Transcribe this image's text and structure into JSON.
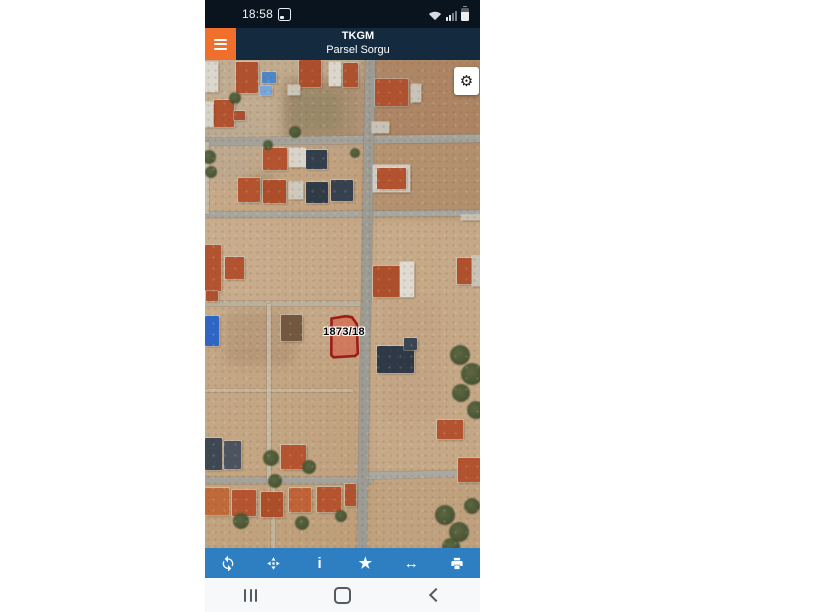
{
  "statusbar": {
    "time": "18:58",
    "bg": "#0a141f",
    "icons": [
      "screenshot-icon",
      "wifi-icon",
      "signal-icon",
      "battery-icon"
    ]
  },
  "header": {
    "title": "TKGM",
    "subtitle": "Parsel Sorgu",
    "bg": "#142a3f",
    "menu_color": "#f16f2c"
  },
  "map": {
    "parcel_label": "1873/18",
    "parcel_fill": "rgba(219,85,64,0.55)",
    "parcel_stroke": "#9d1c17",
    "gear_glyph": "⚙",
    "patches": [
      {
        "x": -10,
        "y": -10,
        "w": 180,
        "h": 100,
        "color": "rgba(190,174,152,0.55)"
      },
      {
        "x": 78,
        "y": 18,
        "w": 80,
        "h": 65,
        "color": "rgba(152,118,85,0.5)"
      },
      {
        "x": 160,
        "y": -10,
        "w": 130,
        "h": 95,
        "color": "rgba(164,122,90,0.65)"
      },
      {
        "x": 162,
        "y": 88,
        "w": 120,
        "h": 68,
        "color": "rgba(170,133,100,0.5)"
      },
      {
        "x": -10,
        "y": 158,
        "w": 175,
        "h": 130,
        "color": "rgba(203,177,147,0.5)"
      },
      {
        "x": -10,
        "y": 255,
        "w": 175,
        "h": 175,
        "color": "rgba(196,168,133,0.5)"
      },
      {
        "x": 165,
        "y": 158,
        "w": 120,
        "h": 260,
        "color": "rgba(206,182,152,0.55)"
      },
      {
        "x": 165,
        "y": 412,
        "w": 120,
        "h": 86,
        "color": "rgba(198,171,139,0.5)"
      },
      {
        "x": -10,
        "y": 420,
        "w": 185,
        "h": 80,
        "color": "rgba(192,161,124,0.5)"
      },
      {
        "x": 82,
        "y": 30,
        "w": 55,
        "h": 42,
        "color": "rgba(122,126,92,0.35)"
      },
      {
        "x": 38,
        "y": 116,
        "w": 34,
        "h": 20,
        "color": "rgba(112,120,88,0.4)"
      },
      {
        "x": 20,
        "y": 250,
        "w": 70,
        "h": 55,
        "color": "rgba(152,122,92,0.3)"
      },
      {
        "x": 175,
        "y": 240,
        "w": 60,
        "h": 120,
        "color": "rgba(188,158,128,0.35)"
      },
      {
        "x": -10,
        "y": 60,
        "w": 60,
        "h": 60,
        "color": "rgba(180,168,150,0.4)"
      }
    ],
    "roads": [
      {
        "x": -5,
        "y": 76,
        "w": 290,
        "h": 8,
        "color": "#a3a29b",
        "rot": -0.7
      },
      {
        "x": -5,
        "y": 151,
        "w": 290,
        "h": 6,
        "color": "#a6a59e",
        "rot": -0.4
      },
      {
        "x": 0,
        "y": 241,
        "w": 163,
        "h": 5,
        "color": "rgba(184,176,158,0.95)"
      },
      {
        "x": 0,
        "y": 329,
        "w": 148,
        "h": 3,
        "color": "rgba(200,190,168,0.6)"
      },
      {
        "x": 0,
        "y": 417,
        "w": 168,
        "h": 7,
        "color": "#a3a29b"
      },
      {
        "x": 162,
        "y": 411,
        "w": 113,
        "h": 7,
        "color": "#a9a8a1",
        "rot": -1.2
      },
      {
        "x": 156,
        "y": -6,
        "w": 10,
        "h": 505,
        "color": "#9c9b94",
        "rot": 1.0
      },
      {
        "x": 62,
        "y": 244,
        "w": 4,
        "h": 178,
        "color": "rgba(197,188,168,0.85)"
      },
      {
        "x": 66,
        "y": 424,
        "w": 4,
        "h": 64,
        "color": "rgba(197,188,168,0.7)"
      },
      {
        "x": 0,
        "y": 82,
        "w": 4,
        "h": 72,
        "color": "rgba(200,195,180,0.7)"
      }
    ],
    "houses": [
      {
        "x": 0,
        "y": 2,
        "w": 13,
        "h": 30,
        "color": "#dcd7cd"
      },
      {
        "x": 31,
        "y": 2,
        "w": 22,
        "h": 31,
        "color": "#b1512e"
      },
      {
        "x": 57,
        "y": 12,
        "w": 14,
        "h": 11,
        "color": "#4e85c8"
      },
      {
        "x": 55,
        "y": 26,
        "w": 12,
        "h": 9,
        "color": "#79a6da"
      },
      {
        "x": 94,
        "y": 0,
        "w": 22,
        "h": 27,
        "color": "#ac4d2b"
      },
      {
        "x": 124,
        "y": 2,
        "w": 12,
        "h": 24,
        "color": "#dcd7cd"
      },
      {
        "x": 138,
        "y": 3,
        "w": 15,
        "h": 24,
        "color": "#ae512e"
      },
      {
        "x": 9,
        "y": 40,
        "w": 20,
        "h": 27,
        "color": "#b2522e"
      },
      {
        "x": 0,
        "y": 42,
        "w": 8,
        "h": 25,
        "color": "#d8d3c8"
      },
      {
        "x": 29,
        "y": 51,
        "w": 11,
        "h": 9,
        "color": "#a85030"
      },
      {
        "x": 170,
        "y": 19,
        "w": 33,
        "h": 27,
        "color": "#b0522f"
      },
      {
        "x": 206,
        "y": 24,
        "w": 10,
        "h": 18,
        "color": "#c9c4b8"
      },
      {
        "x": 167,
        "y": 62,
        "w": 17,
        "h": 11,
        "color": "#c6c2b6"
      },
      {
        "x": 83,
        "y": 25,
        "w": 12,
        "h": 10,
        "color": "#cac5b9"
      },
      {
        "x": 58,
        "y": 88,
        "w": 24,
        "h": 22,
        "color": "#b4532e"
      },
      {
        "x": 84,
        "y": 88,
        "w": 17,
        "h": 19,
        "color": "#d9d4c9"
      },
      {
        "x": 101,
        "y": 90,
        "w": 21,
        "h": 19,
        "color": "#333e4c"
      },
      {
        "x": 33,
        "y": 118,
        "w": 22,
        "h": 24,
        "color": "#b4532e"
      },
      {
        "x": 58,
        "y": 120,
        "w": 23,
        "h": 23,
        "color": "#ad4d2a"
      },
      {
        "x": 84,
        "y": 122,
        "w": 14,
        "h": 17,
        "color": "#cfc9bd"
      },
      {
        "x": 101,
        "y": 122,
        "w": 22,
        "h": 21,
        "color": "#2f3a47"
      },
      {
        "x": 126,
        "y": 120,
        "w": 22,
        "h": 21,
        "color": "#36414f"
      },
      {
        "x": 168,
        "y": 105,
        "w": 37,
        "h": 27,
        "color": "#d2cdc1"
      },
      {
        "x": 172,
        "y": 108,
        "w": 29,
        "h": 21,
        "color": "#b2522f"
      },
      {
        "x": 0,
        "y": 185,
        "w": 16,
        "h": 46,
        "color": "#b4532f"
      },
      {
        "x": 20,
        "y": 197,
        "w": 19,
        "h": 22,
        "color": "#b4532f"
      },
      {
        "x": 1,
        "y": 231,
        "w": 12,
        "h": 10,
        "color": "#ad512f"
      },
      {
        "x": 0,
        "y": 256,
        "w": 14,
        "h": 30,
        "color": "#2e66c8"
      },
      {
        "x": 76,
        "y": 255,
        "w": 21,
        "h": 26,
        "color": "#73573f"
      },
      {
        "x": 168,
        "y": 206,
        "w": 27,
        "h": 31,
        "color": "#ae4f2b"
      },
      {
        "x": 195,
        "y": 202,
        "w": 14,
        "h": 35,
        "color": "#e0dbd1"
      },
      {
        "x": 172,
        "y": 286,
        "w": 37,
        "h": 27,
        "color": "#2e3947"
      },
      {
        "x": 199,
        "y": 278,
        "w": 13,
        "h": 12,
        "color": "#3a4553"
      },
      {
        "x": 252,
        "y": 198,
        "w": 16,
        "h": 26,
        "color": "#b0512d"
      },
      {
        "x": 267,
        "y": 196,
        "w": 8,
        "h": 30,
        "color": "#c8c3b7"
      },
      {
        "x": 256,
        "y": 155,
        "w": 19,
        "h": 5,
        "color": "rgba(205,202,192,0.8)"
      },
      {
        "x": 232,
        "y": 360,
        "w": 26,
        "h": 19,
        "color": "#b4532f"
      },
      {
        "x": 253,
        "y": 398,
        "w": 22,
        "h": 24,
        "color": "#b4532f"
      },
      {
        "x": 0,
        "y": 378,
        "w": 17,
        "h": 32,
        "color": "#3e4854"
      },
      {
        "x": 19,
        "y": 381,
        "w": 17,
        "h": 28,
        "color": "#4a535f"
      },
      {
        "x": 76,
        "y": 385,
        "w": 25,
        "h": 24,
        "color": "#b5542f"
      },
      {
        "x": 0,
        "y": 428,
        "w": 24,
        "h": 27,
        "color": "#bf6a38"
      },
      {
        "x": 27,
        "y": 430,
        "w": 24,
        "h": 26,
        "color": "#b5542f"
      },
      {
        "x": 56,
        "y": 432,
        "w": 22,
        "h": 25,
        "color": "#ad4e2b"
      },
      {
        "x": 84,
        "y": 428,
        "w": 22,
        "h": 24,
        "color": "#c06338"
      },
      {
        "x": 112,
        "y": 427,
        "w": 24,
        "h": 25,
        "color": "#b5542f"
      },
      {
        "x": 140,
        "y": 424,
        "w": 11,
        "h": 22,
        "color": "#b0522d"
      }
    ],
    "trees": [
      {
        "x": 30,
        "y": 38,
        "r": 6
      },
      {
        "x": 90,
        "y": 72,
        "r": 6
      },
      {
        "x": 4,
        "y": 97,
        "r": 7
      },
      {
        "x": 6,
        "y": 112,
        "r": 6
      },
      {
        "x": 63,
        "y": 85,
        "r": 5
      },
      {
        "x": 150,
        "y": 93,
        "r": 5
      },
      {
        "x": 255,
        "y": 295,
        "r": 10
      },
      {
        "x": 267,
        "y": 314,
        "r": 11
      },
      {
        "x": 256,
        "y": 333,
        "r": 9
      },
      {
        "x": 271,
        "y": 350,
        "r": 9
      },
      {
        "x": 66,
        "y": 398,
        "r": 8
      },
      {
        "x": 104,
        "y": 407,
        "r": 7
      },
      {
        "x": 70,
        "y": 421,
        "r": 7
      },
      {
        "x": 36,
        "y": 461,
        "r": 8
      },
      {
        "x": 97,
        "y": 463,
        "r": 7
      },
      {
        "x": 136,
        "y": 456,
        "r": 6
      },
      {
        "x": 240,
        "y": 455,
        "r": 10
      },
      {
        "x": 254,
        "y": 472,
        "r": 10
      },
      {
        "x": 267,
        "y": 446,
        "r": 8
      },
      {
        "x": 246,
        "y": 487,
        "r": 9
      }
    ]
  },
  "toolbar": {
    "bg": "#2e7fc2",
    "buttons": [
      {
        "id": "refresh",
        "icon": "refresh-icon"
      },
      {
        "id": "locate",
        "icon": "locate-icon"
      },
      {
        "id": "info",
        "glyph": "i"
      },
      {
        "id": "favorite",
        "glyph": "★"
      },
      {
        "id": "measure",
        "glyph": "↔"
      },
      {
        "id": "print",
        "icon": "printer-icon"
      }
    ]
  },
  "navbar": {
    "buttons": [
      "recents",
      "home",
      "back"
    ]
  }
}
